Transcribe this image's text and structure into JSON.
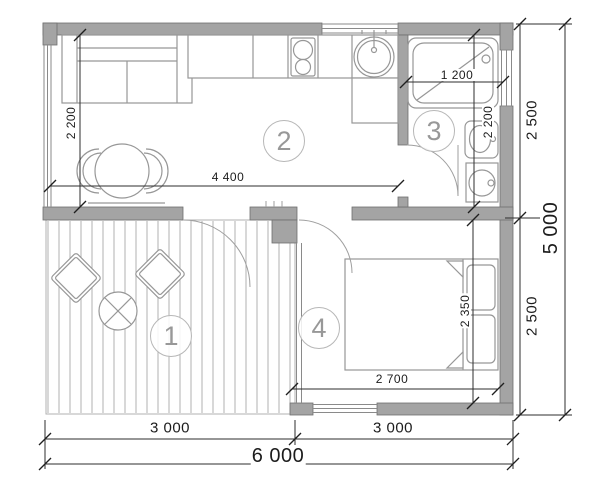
{
  "drawing_type": "floor-plan",
  "rooms": {
    "terrace": "1",
    "living": "2",
    "bathroom": "3",
    "bedroom": "4"
  },
  "dims": {
    "living_depth": "2 200",
    "living_width": "4 400",
    "tub_length": "1 200",
    "bath_depth": "2 200",
    "right_upper": "2 500",
    "right_lower": "2 500",
    "total_height": "5 000",
    "bedroom_depth": "2 350",
    "bedroom_width": "2 700",
    "bottom_left": "3 000",
    "bottom_right": "3 000",
    "total_width": "6 000"
  },
  "colors": {
    "wall_fill": "#a4a4a4",
    "wall_edge": "#6f6f6f",
    "furniture_line": "#979797",
    "deck_line": "#b2b2b2",
    "dimension_line": "#2d2d2d",
    "dimension_text": "#1c1c1c",
    "room_badge": "#989898",
    "background": "#ffffff"
  }
}
